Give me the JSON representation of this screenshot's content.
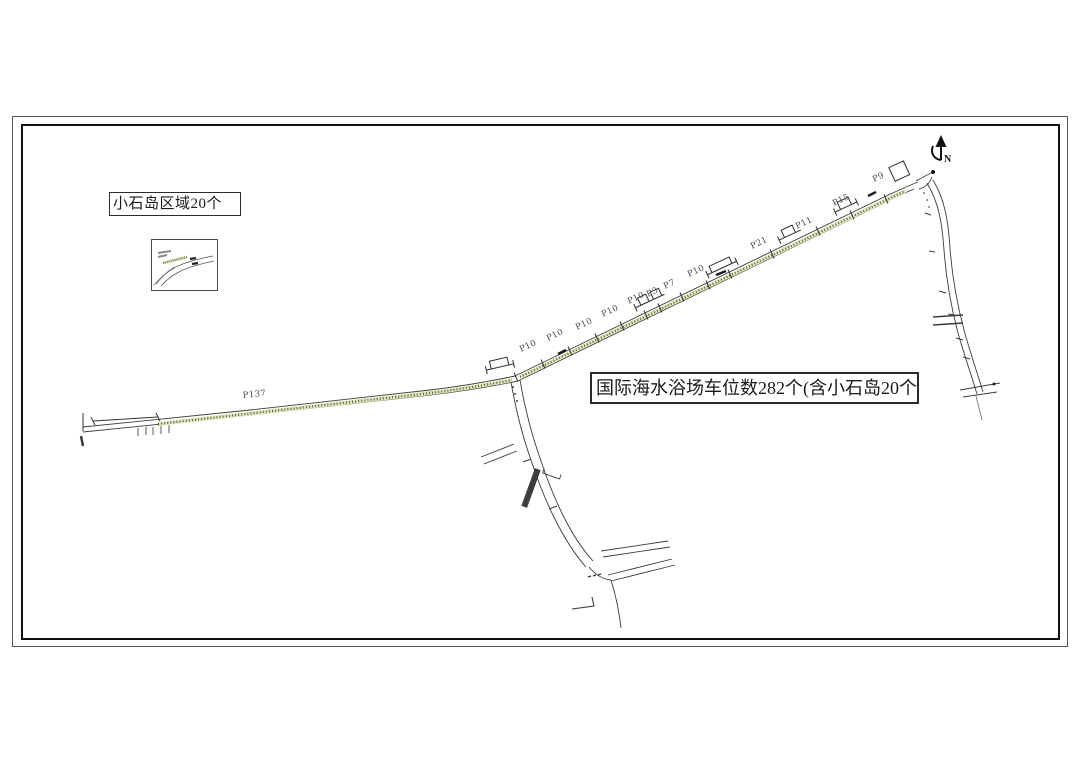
{
  "labels": {
    "area_label": "小石岛区域20个",
    "total_label": "国际海水浴场车位数282个(含小石岛20个)",
    "north_label": "N"
  },
  "colors": {
    "line": "#2b2b2b",
    "road_edge": "#3c3c3c",
    "strip_fill": "#dfe7ba",
    "strip_dash": "#5a5a4a",
    "label_text": "#4a4a4a"
  },
  "road_labels": [
    {
      "text": "P137",
      "x": 243,
      "y": 398,
      "rot": -6
    },
    {
      "text": "P10",
      "x": 521,
      "y": 352,
      "rot": -25
    },
    {
      "text": "P10",
      "x": 548,
      "y": 341,
      "rot": -25
    },
    {
      "text": "P10",
      "x": 577,
      "y": 330,
      "rot": -25
    },
    {
      "text": "P10",
      "x": 603,
      "y": 317,
      "rot": -25
    },
    {
      "text": "P10",
      "x": 629,
      "y": 304,
      "rot": -25
    },
    {
      "text": "P3",
      "x": 648,
      "y": 297,
      "rot": -25
    },
    {
      "text": "P7",
      "x": 665,
      "y": 289,
      "rot": -25
    },
    {
      "text": "P10",
      "x": 689,
      "y": 277,
      "rot": -25
    },
    {
      "text": "P21",
      "x": 752,
      "y": 249,
      "rot": -25
    },
    {
      "text": "P11",
      "x": 797,
      "y": 229,
      "rot": -25
    },
    {
      "text": "P15",
      "x": 834,
      "y": 206,
      "rot": -25
    },
    {
      "text": "P9",
      "x": 874,
      "y": 182,
      "rot": -25
    }
  ]
}
